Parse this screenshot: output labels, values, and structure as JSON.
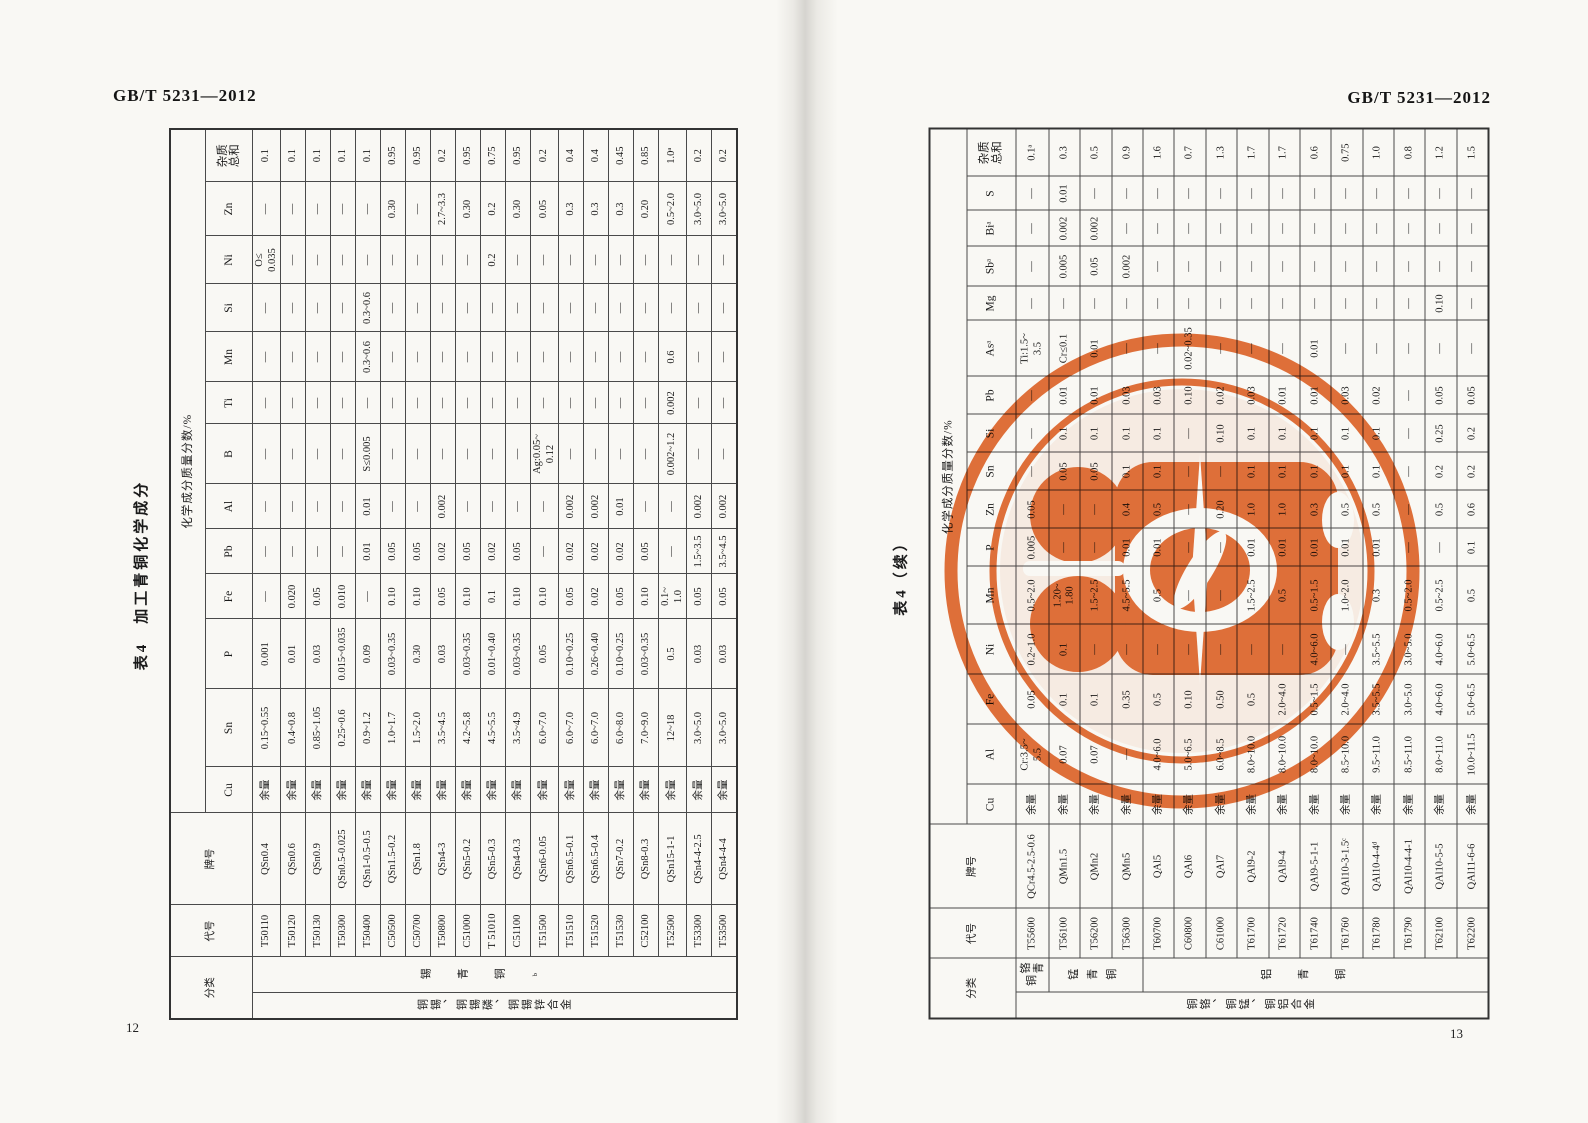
{
  "page_left": {
    "header": "GB/T 5231—2012",
    "page_number": "12",
    "table_title": "表4　加工青铜化学成分",
    "table": {
      "corner": {
        "classification": "分类",
        "code": "代号",
        "grade": "牌号"
      },
      "group_label": "化学成分质量分数/%",
      "elements": [
        "Cu",
        "Sn",
        "P",
        "Fe",
        "Pb",
        "Al",
        "B",
        "Ti",
        "Mn",
        "Si",
        "Ni",
        "Zn",
        "杂质\n总和"
      ],
      "classification": {
        "outer": "铜锡、铜锡磷、铜锡锌合金",
        "inner": [
          {
            "label": "锡青铜ᵇ",
            "span": 19
          }
        ]
      },
      "rows": [
        {
          "code": "T50110",
          "grade": "QSn0.4",
          "values": [
            "余量",
            "0.15~0.55",
            "0.001",
            "—",
            "—",
            "—",
            "—",
            "—",
            "—",
            "—",
            "O≤\n0.035",
            "—",
            "0.1"
          ]
        },
        {
          "code": "T50120",
          "grade": "QSn0.6",
          "values": [
            "余量",
            "0.4~0.8",
            "0.01",
            "0.020",
            "—",
            "—",
            "—",
            "—",
            "—",
            "—",
            "—",
            "—",
            "0.1"
          ]
        },
        {
          "code": "T50130",
          "grade": "QSn0.9",
          "values": [
            "余量",
            "0.85~1.05",
            "0.03",
            "0.05",
            "—",
            "—",
            "—",
            "—",
            "—",
            "—",
            "—",
            "—",
            "0.1"
          ]
        },
        {
          "code": "T50300",
          "grade": "QSn0.5-0.025",
          "values": [
            "余量",
            "0.25~0.6",
            "0.015~0.035",
            "0.010",
            "—",
            "—",
            "—",
            "—",
            "—",
            "—",
            "—",
            "—",
            "0.1"
          ]
        },
        {
          "code": "T50400",
          "grade": "QSn1-0.5-0.5",
          "values": [
            "余量",
            "0.9~1.2",
            "0.09",
            "—",
            "0.01",
            "0.01",
            "S≤0.005",
            "—",
            "0.3~0.6",
            "0.3~0.6",
            "—",
            "—",
            "0.1"
          ]
        },
        {
          "code": "C50500",
          "grade": "QSn1.5-0.2",
          "values": [
            "余量",
            "1.0~1.7",
            "0.03~0.35",
            "0.10",
            "0.05",
            "—",
            "—",
            "—",
            "—",
            "—",
            "—",
            "0.30",
            "0.95"
          ]
        },
        {
          "code": "C50700",
          "grade": "QSn1.8",
          "values": [
            "余量",
            "1.5~2.0",
            "0.30",
            "0.10",
            "0.05",
            "—",
            "—",
            "—",
            "—",
            "—",
            "—",
            "—",
            "0.95"
          ]
        },
        {
          "code": "T50800",
          "grade": "QSn4-3",
          "values": [
            "余量",
            "3.5~4.5",
            "0.03",
            "0.05",
            "0.02",
            "0.002",
            "—",
            "—",
            "—",
            "—",
            "—",
            "2.7~3.3",
            "0.2"
          ]
        },
        {
          "code": "C51000",
          "grade": "QSn5-0.2",
          "values": [
            "余量",
            "4.2~5.8",
            "0.03~0.35",
            "0.10",
            "0.05",
            "—",
            "—",
            "—",
            "—",
            "—",
            "—",
            "0.30",
            "0.95"
          ]
        },
        {
          "code": "T 51010",
          "grade": "QSn5-0.3",
          "values": [
            "余量",
            "4.5~5.5",
            "0.01~0.40",
            "0.1",
            "0.02",
            "—",
            "—",
            "—",
            "—",
            "—",
            "0.2",
            "0.2",
            "0.75"
          ]
        },
        {
          "code": "C51100",
          "grade": "QSn4-0.3",
          "values": [
            "余量",
            "3.5~4.9",
            "0.03~0.35",
            "0.10",
            "0.05",
            "—",
            "—",
            "—",
            "—",
            "—",
            "—",
            "0.30",
            "0.95"
          ]
        },
        {
          "code": "T51500",
          "grade": "QSn6-0.05",
          "values": [
            "余量",
            "6.0~7.0",
            "0.05",
            "0.10",
            "—",
            "—",
            "Ag:0.05~\n0.12",
            "—",
            "—",
            "—",
            "—",
            "0.05",
            "0.2"
          ]
        },
        {
          "code": "T51510",
          "grade": "QSn6.5-0.1",
          "values": [
            "余量",
            "6.0~7.0",
            "0.10~0.25",
            "0.05",
            "0.02",
            "0.002",
            "—",
            "—",
            "—",
            "—",
            "—",
            "0.3",
            "0.4"
          ]
        },
        {
          "code": "T51520",
          "grade": "QSn6.5-0.4",
          "values": [
            "余量",
            "6.0~7.0",
            "0.26~0.40",
            "0.02",
            "0.02",
            "0.002",
            "—",
            "—",
            "—",
            "—",
            "—",
            "0.3",
            "0.4"
          ]
        },
        {
          "code": "T51530",
          "grade": "QSn7-0.2",
          "values": [
            "余量",
            "6.0~8.0",
            "0.10~0.25",
            "0.05",
            "0.02",
            "0.01",
            "—",
            "—",
            "—",
            "—",
            "—",
            "0.3",
            "0.45"
          ]
        },
        {
          "code": "C52100",
          "grade": "QSn8-0.3",
          "values": [
            "余量",
            "7.0~9.0",
            "0.03~0.35",
            "0.10",
            "0.05",
            "—",
            "—",
            "—",
            "—",
            "—",
            "—",
            "0.20",
            "0.85"
          ]
        },
        {
          "code": "T52500",
          "grade": "QSn15-1-1",
          "values": [
            "余量",
            "12~18",
            "0.5",
            "0.1~\n1.0",
            "—",
            "—",
            "0.002~1.2",
            "0.002",
            "0.6",
            "—",
            "—",
            "0.5~2.0",
            "1.0ᵃ"
          ]
        },
        {
          "code": "T53300",
          "grade": "QSn4-4-2.5",
          "values": [
            "余量",
            "3.0~5.0",
            "0.03",
            "0.05",
            "1.5~3.5",
            "0.002",
            "—",
            "—",
            "—",
            "—",
            "—",
            "3.0~5.0",
            "0.2"
          ]
        },
        {
          "code": "T53500",
          "grade": "QSn4-4-4",
          "values": [
            "余量",
            "3.0~5.0",
            "0.03",
            "0.05",
            "3.5~4.5",
            "0.002",
            "—",
            "—",
            "—",
            "—",
            "—",
            "3.0~5.0",
            "0.2"
          ]
        }
      ]
    }
  },
  "page_right": {
    "header": "GB/T 5231—2012",
    "page_number": "13",
    "table_title": "表4（续）",
    "table": {
      "corner": {
        "classification": "分类",
        "code": "代号",
        "grade": "牌号"
      },
      "group_label": "化学成分质量分数/%",
      "elements": [
        "Cu",
        "Al",
        "Fe",
        "Ni",
        "Mn",
        "P",
        "Zn",
        "Sn",
        "Si",
        "Pb",
        "Asᵃ",
        "Mg",
        "Sbᵃ",
        "Biᵃ",
        "S",
        "杂质\n总和"
      ],
      "classification": {
        "outer": "铜铬、铜锰、铜铝合金",
        "inner": [
          {
            "label": "铬青铜",
            "span": 1
          },
          {
            "label": "锰青铜",
            "span": 3
          },
          {
            "label": "铝青铜",
            "span": 11
          }
        ]
      },
      "rows": [
        {
          "code": "T55600",
          "grade": "QCr4.5-2.5-0.6",
          "values": [
            "余量",
            "Cr:3.5~\n5.5",
            "0.05",
            "0.2~1.0",
            "0.5~2.0",
            "0.005",
            "0.05",
            "—",
            "—",
            "—",
            "Ti:1.5~\n3.5",
            "—",
            "—",
            "—",
            "—",
            "0.1ᵃ"
          ]
        },
        {
          "code": "T56100",
          "grade": "QMn1.5",
          "values": [
            "余量",
            "0.07",
            "0.1",
            "0.1",
            "1.20~\n1.80",
            "—",
            "—",
            "0.05",
            "0.1",
            "0.01",
            "Cr≤0.1",
            "—",
            "0.005",
            "0.002",
            "0.01",
            "0.3"
          ]
        },
        {
          "code": "T56200",
          "grade": "QMn2",
          "values": [
            "余量",
            "0.07",
            "0.1",
            "—",
            "1.5~2.5",
            "—",
            "—",
            "0.05",
            "0.1",
            "0.01",
            "0.01",
            "—",
            "0.05",
            "0.002",
            "—",
            "0.5"
          ]
        },
        {
          "code": "T56300",
          "grade": "QMn5",
          "values": [
            "余量",
            "—",
            "0.35",
            "—",
            "4.5~5.5",
            "0.01",
            "0.4",
            "0.1",
            "0.1",
            "0.03",
            "—",
            "—",
            "0.002",
            "—",
            "—",
            "0.9"
          ]
        },
        {
          "code": "T60700",
          "grade": "QAl5",
          "values": [
            "余量",
            "4.0~6.0",
            "0.5",
            "—",
            "0.5",
            "0.01",
            "0.5",
            "0.1",
            "0.1",
            "0.03",
            "—",
            "—",
            "—",
            "—",
            "—",
            "1.6"
          ]
        },
        {
          "code": "C60800",
          "grade": "QAl6",
          "values": [
            "余量",
            "5.0~6.5",
            "0.10",
            "—",
            "—",
            "—",
            "—",
            "—",
            "—",
            "0.10",
            "0.02~0.35",
            "—",
            "—",
            "—",
            "—",
            "0.7"
          ]
        },
        {
          "code": "C61000",
          "grade": "QAl7",
          "values": [
            "余量",
            "6.0~8.5",
            "0.50",
            "—",
            "—",
            "—",
            "0.20",
            "—",
            "0.10",
            "0.02",
            "—",
            "—",
            "—",
            "—",
            "—",
            "1.3"
          ]
        },
        {
          "code": "T61700",
          "grade": "QAl9-2",
          "values": [
            "余量",
            "8.0~10.0",
            "0.5",
            "—",
            "1.5~2.5",
            "0.01",
            "1.0",
            "0.1",
            "0.1",
            "0.03",
            "—",
            "—",
            "—",
            "—",
            "—",
            "1.7"
          ]
        },
        {
          "code": "T61720",
          "grade": "QAl9-4",
          "values": [
            "余量",
            "8.0~10.0",
            "2.0~4.0",
            "—",
            "0.5",
            "0.01",
            "1.0",
            "0.1",
            "0.1",
            "0.01",
            "—",
            "—",
            "—",
            "—",
            "—",
            "1.7"
          ]
        },
        {
          "code": "T61740",
          "grade": "QAl9-5-1-1",
          "values": [
            "余量",
            "8.0~10.0",
            "0.5~1.5",
            "4.0~6.0",
            "0.5~1.5",
            "0.01",
            "0.3",
            "0.1",
            "0.1",
            "0.01",
            "0.01",
            "—",
            "—",
            "—",
            "—",
            "0.6"
          ]
        },
        {
          "code": "T61760",
          "grade": "QAl10-3-1.5ᶜ",
          "values": [
            "余量",
            "8.5~10.0",
            "2.0~4.0",
            "—",
            "1.0~2.0",
            "0.01",
            "0.5",
            "0.1",
            "0.1",
            "0.03",
            "—",
            "—",
            "—",
            "—",
            "—",
            "0.75"
          ]
        },
        {
          "code": "T61780",
          "grade": "QAl10-4-4ᵈ",
          "values": [
            "余量",
            "9.5~11.0",
            "3.5~5.5",
            "3.5~5.5",
            "0.3",
            "0.01",
            "0.5",
            "0.1",
            "0.1",
            "0.02",
            "—",
            "—",
            "—",
            "—",
            "—",
            "1.0"
          ]
        },
        {
          "code": "T61790",
          "grade": "QAl10-4-4-1",
          "values": [
            "余量",
            "8.5~11.0",
            "3.0~5.0",
            "3.0~5.0",
            "0.5~2.0",
            "—",
            "—",
            "—",
            "—",
            "—",
            "—",
            "—",
            "—",
            "—",
            "—",
            "0.8"
          ]
        },
        {
          "code": "T62100",
          "grade": "QAl10-5-5",
          "values": [
            "余量",
            "8.0~11.0",
            "4.0~6.0",
            "4.0~6.0",
            "0.5~2.5",
            "—",
            "0.5",
            "0.2",
            "0.25",
            "0.05",
            "—",
            "0.10",
            "—",
            "—",
            "—",
            "1.2"
          ]
        },
        {
          "code": "T62200",
          "grade": "QAl11-6-6",
          "values": [
            "余量",
            "10.0~11.5",
            "5.0~6.5",
            "5.0~6.5",
            "0.5",
            "0.1",
            "0.6",
            "0.2",
            "0.2",
            "0.05",
            "—",
            "—",
            "—",
            "—",
            "—",
            "1.5"
          ]
        }
      ]
    }
  },
  "stamp": {
    "color": "#e2662a"
  }
}
